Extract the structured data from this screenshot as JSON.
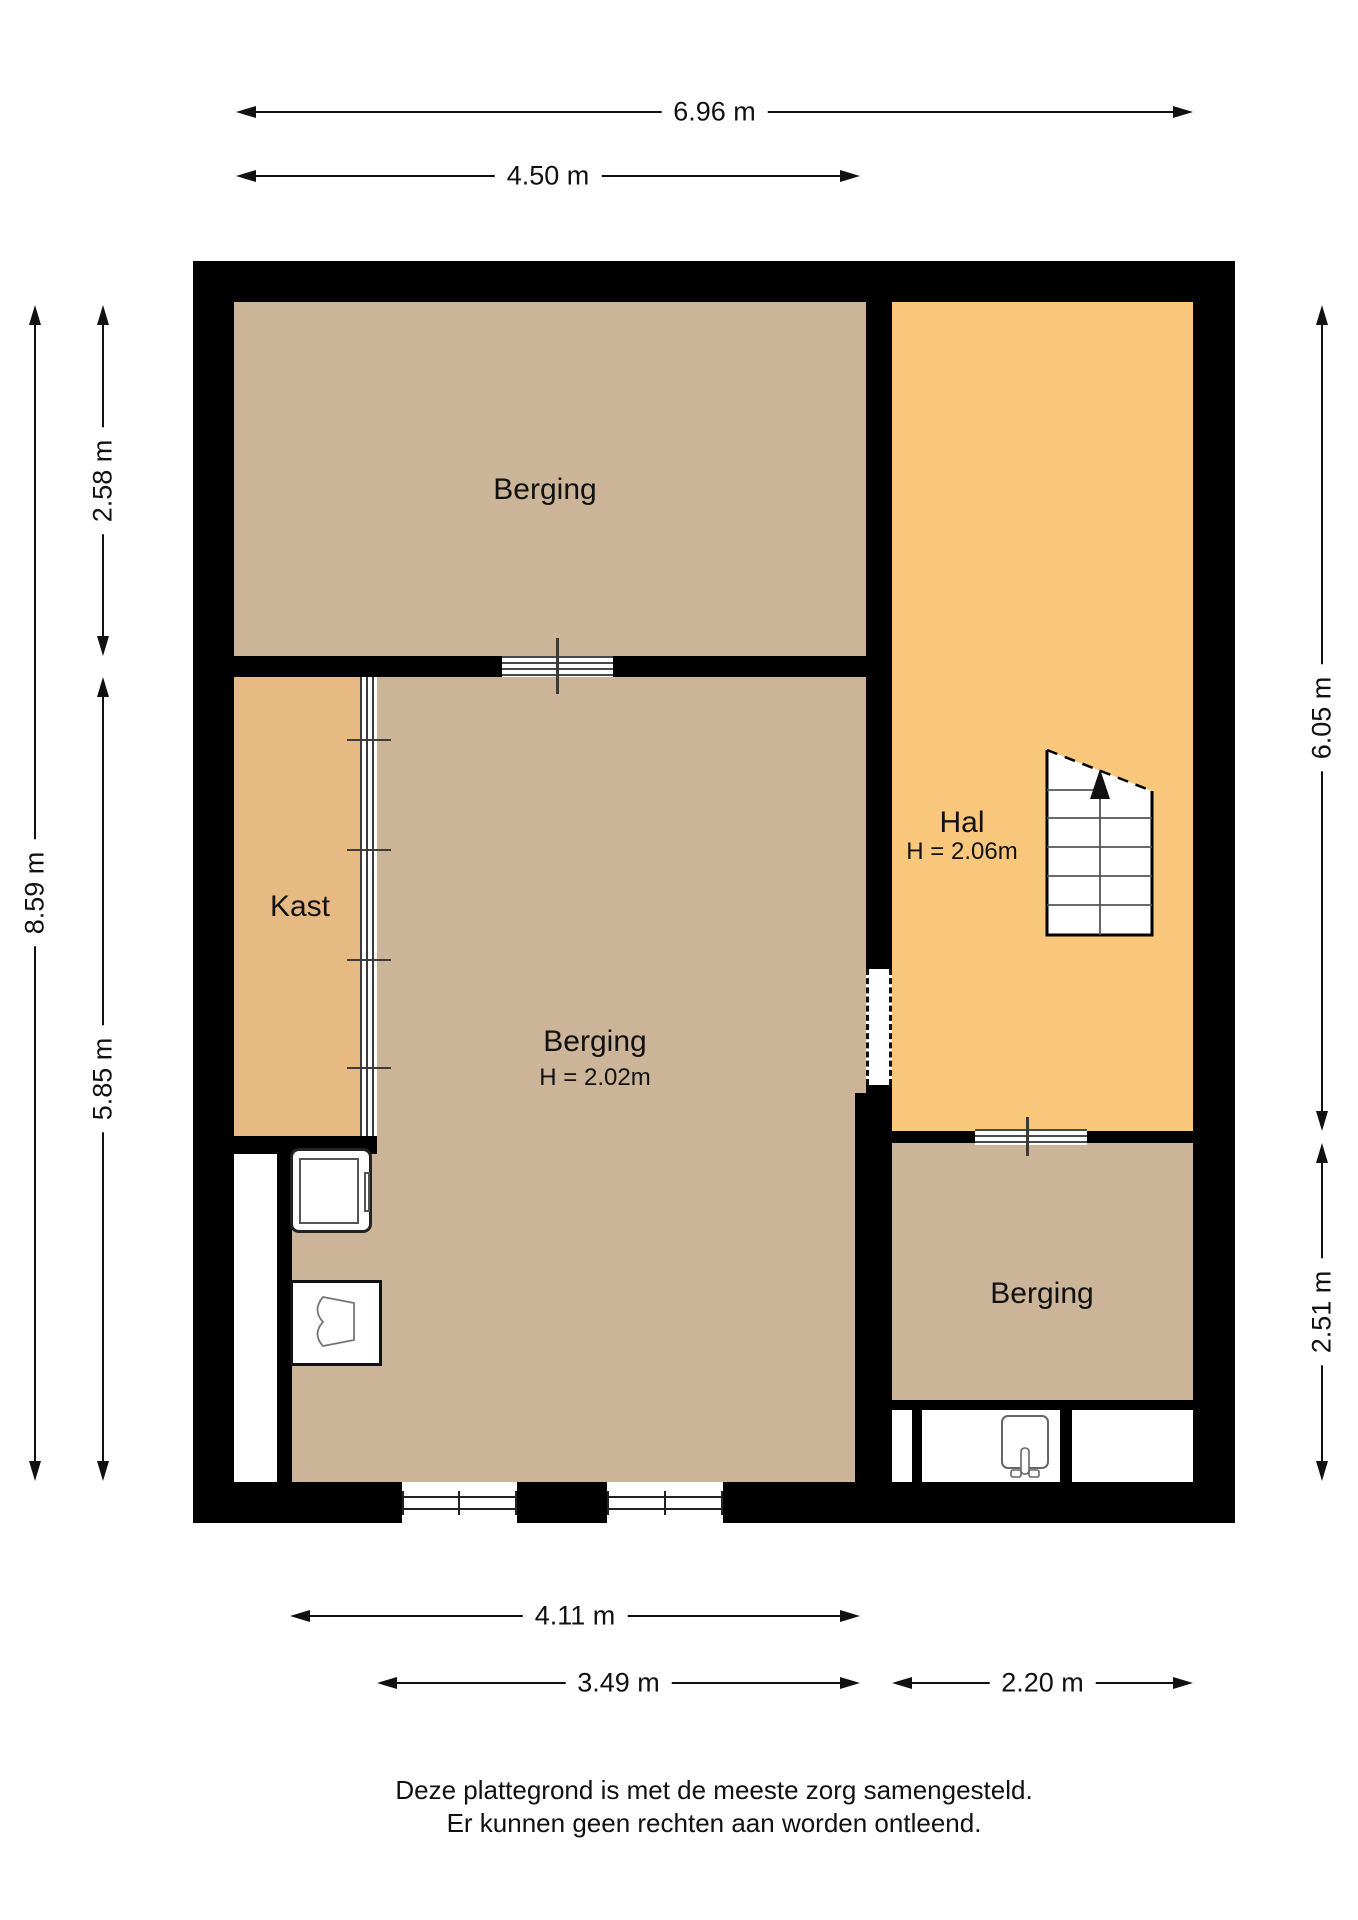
{
  "plan_type": "floor-plan",
  "rooms": [
    {
      "id": "berging-top",
      "label": "Berging"
    },
    {
      "id": "kast",
      "label": "Kast"
    },
    {
      "id": "berging-central",
      "label": "Berging",
      "height": "H = 2.02m"
    },
    {
      "id": "hal",
      "label": "Hal",
      "height": "H = 2.06m"
    },
    {
      "id": "berging-bottom",
      "label": "Berging"
    }
  ],
  "dimensions": {
    "top_total": "6.96 m",
    "top_inner": "4.50 m",
    "left_total": "8.59 m",
    "left_upper": "2.58 m",
    "left_lower": "5.85 m",
    "right_upper": "6.05 m",
    "right_lower": "2.51 m",
    "bottom_inner": "4.11 m",
    "bottom_left": "3.49 m",
    "bottom_right": "2.20 m"
  },
  "footer": {
    "line1": "Deze plattegrond is met de meeste zorg samengesteld.",
    "line2": "Er kunnen geen rechten aan worden ontleend."
  },
  "colors": {
    "wall": "#000000",
    "floor_berging": "#cbb497",
    "floor_kast": "#e6ba82",
    "floor_hal": "#f9c77b",
    "symbol_line": "#4a4a4a"
  }
}
